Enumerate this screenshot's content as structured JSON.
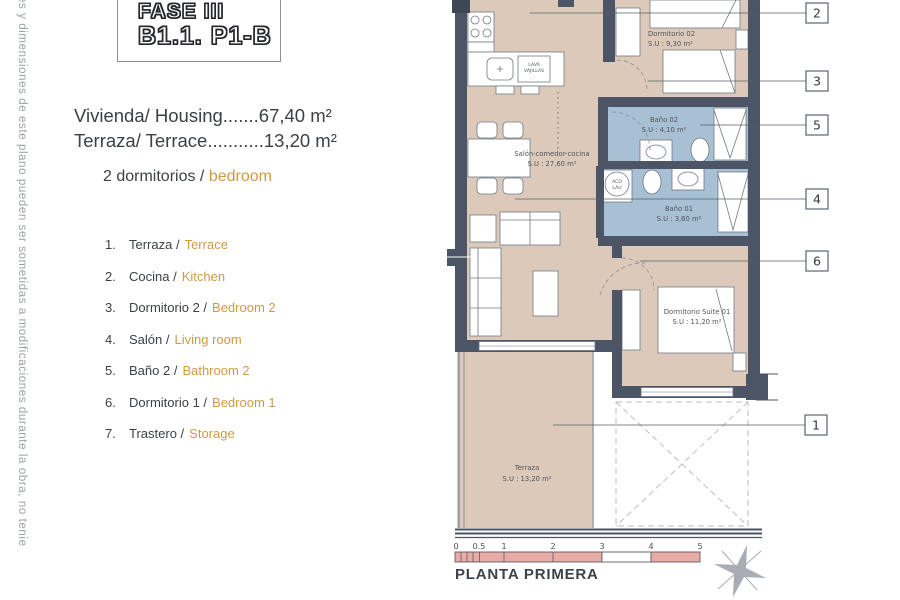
{
  "side_note": "es y dimensiones de este plano pueden ser sometidas a modificaciones durante la obra, no tenie",
  "logo": {
    "line1": "FASE III",
    "line2": "B1.1. P1-B"
  },
  "summary": {
    "housing_label": "Vivienda/ Housing",
    "housing_dots": ".......",
    "housing_value": "67,40 m²",
    "terrace_label": "Terraza/ Terrace",
    "terrace_dots": "...........",
    "terrace_value": "13,20 m²",
    "bedrooms_es": "2 dormitorios / ",
    "bedrooms_en": "bedroom"
  },
  "legend": {
    "items": [
      {
        "num": "1.",
        "es": "Terraza /",
        "en": "Terrace"
      },
      {
        "num": "2.",
        "es": "Cocina /",
        "en": "Kitchen"
      },
      {
        "num": "3.",
        "es": "Dormitorio 2 /",
        "en": "Bedroom 2"
      },
      {
        "num": "4.",
        "es": "Salón /",
        "en": "Living room"
      },
      {
        "num": "5.",
        "es": "Baño 2 /",
        "en": "Bathroom 2"
      },
      {
        "num": "6.",
        "es": "Dormitorio 1 /",
        "en": "Bedroom 1"
      },
      {
        "num": "7.",
        "es": "Trastero /",
        "en": "Storage"
      }
    ]
  },
  "plan": {
    "rooms": {
      "salon": {
        "name": "Salón-comedor-cocina",
        "area": "S.U : 27,60 m²"
      },
      "dorm02": {
        "name": "Dormitorio 02",
        "area": "S.U : 9,30 m²"
      },
      "bano02": {
        "name": "Baño 02",
        "area": "S.U : 4,10 m²"
      },
      "bano01": {
        "name": "Baño 01",
        "area": "S.U : 3,60 m²"
      },
      "suite": {
        "name": "Dormitorio Suite 01",
        "area": "S.U : 11,20 m²"
      },
      "terraza": {
        "name": "Terraza",
        "area": "S.U : 13,20 m²"
      }
    },
    "fixtures": {
      "dishwasher": [
        "LAVA",
        "VAJILLAS"
      ],
      "washer": [
        "ACO",
        "LAU"
      ]
    },
    "callouts": [
      "2",
      "3",
      "5",
      "4",
      "6",
      "1"
    ],
    "scale_ticks": [
      "0",
      "0.5",
      "1",
      "2",
      "3",
      "4",
      "5"
    ],
    "title": "PLANTA PRIMERA",
    "colors": {
      "wall": "#4b5565",
      "floor": "#dcc9ba",
      "bath": "#a8c0d3",
      "accent": "#d09a44",
      "scale_pink": "#e8aba6"
    }
  }
}
